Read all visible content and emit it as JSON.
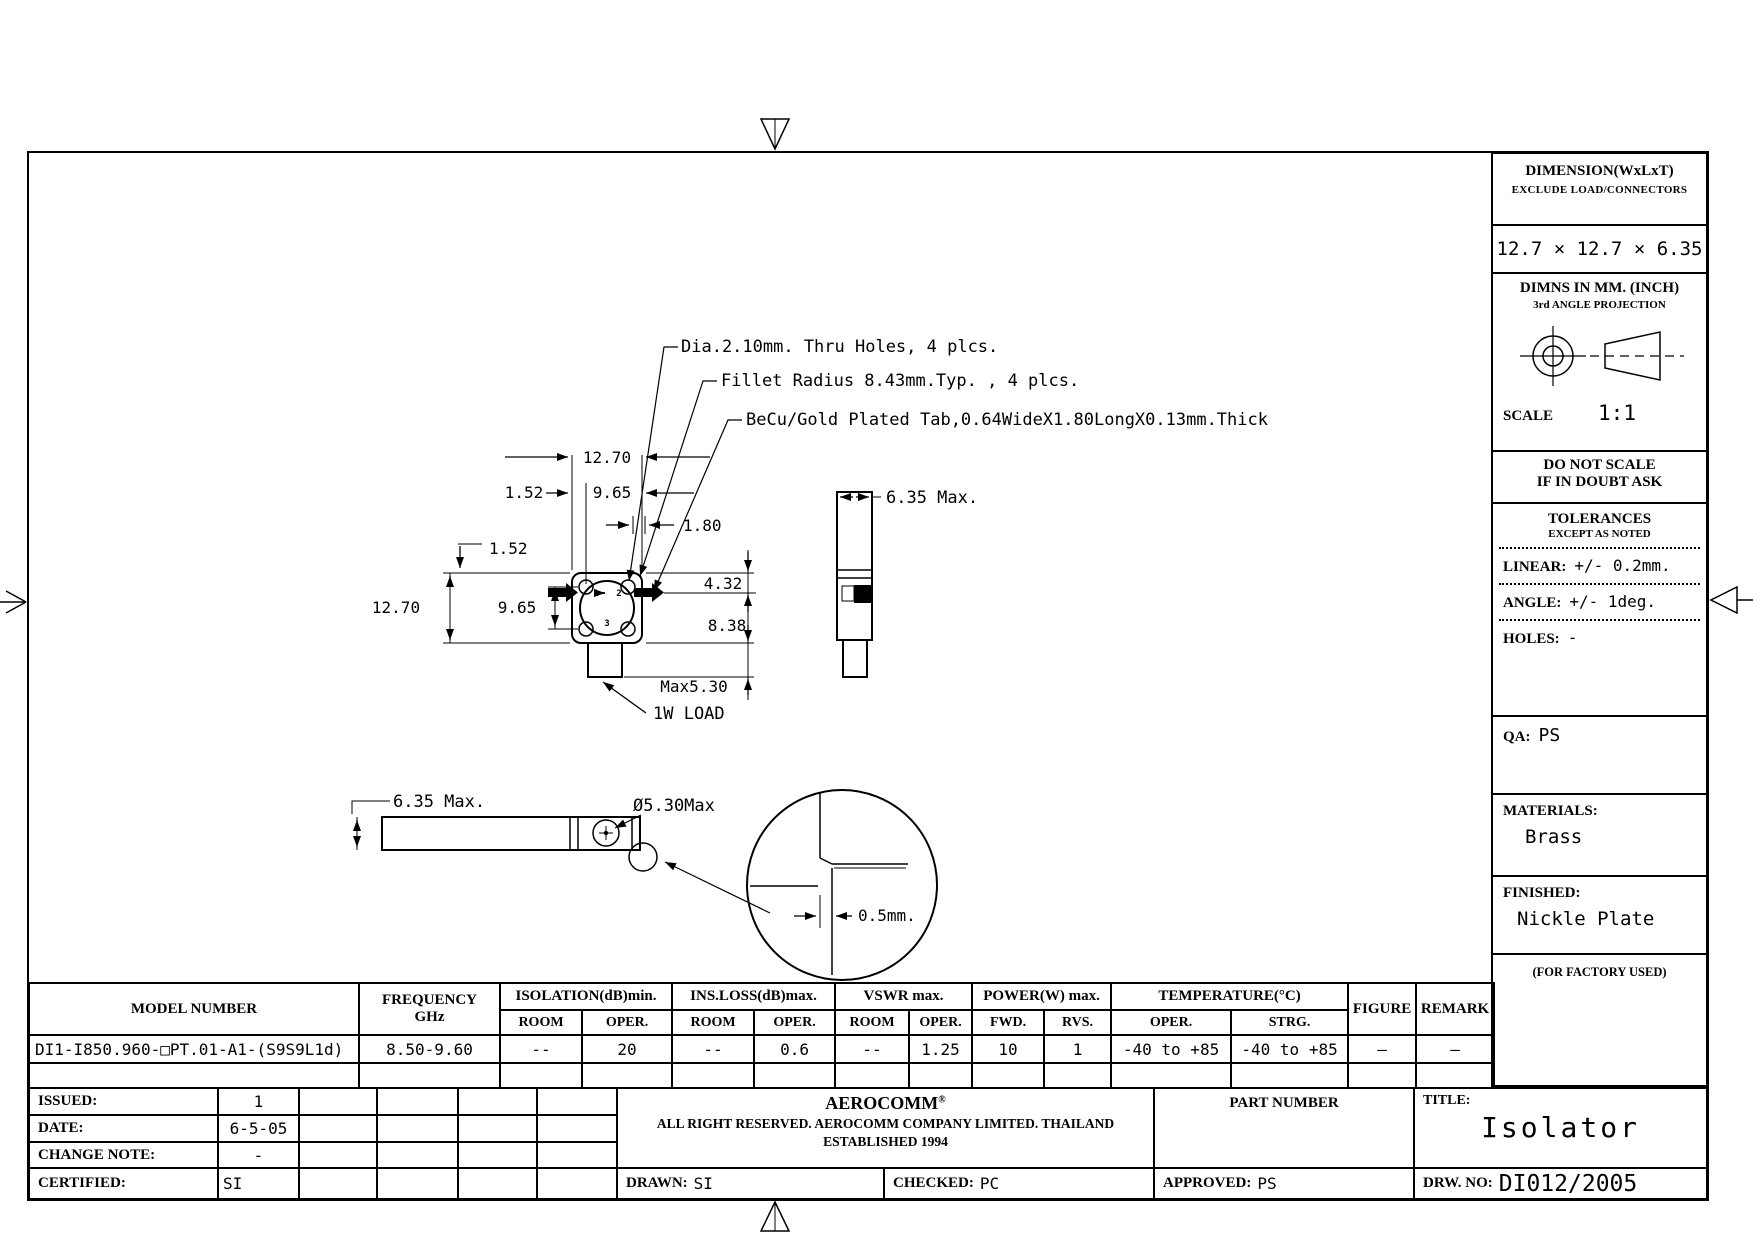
{
  "drawing": {
    "ann_holes": "Dia.2.10mm. Thru Holes, 4 plcs.",
    "ann_fillet": "Fillet Radius 8.43mm.Typ. , 4 plcs.",
    "ann_tab": "BeCu/Gold Plated Tab,0.64WideX1.80LongX0.13mm.Thick",
    "ann_load": "1W LOAD",
    "dim_top_width": "12.70",
    "dim_top_152": "1.52",
    "dim_top_965": "9.65",
    "dim_tab_len": "1.80",
    "dim_hole_off": "1.52",
    "dim_left_height": "12.70",
    "dim_left_holes": "9.65",
    "dim_432": "4.32",
    "dim_838": "8.38",
    "dim_load_len": "Max5.30",
    "port1": "1",
    "port2": "2",
    "port3": "3",
    "side_dim": "6.35 Max.",
    "bottom_dim": "6.35 Max.",
    "bottom_dia": "Ø5.30Max",
    "detail_step": "0.5mm."
  },
  "sidebar": {
    "dim_title": "DIMENSION(WxLxT)",
    "dim_sub": "EXCLUDE LOAD/CONNECTORS",
    "dim_value": "12.7 × 12.7 × 6.35",
    "units_line1": "DIMNS IN MM. (INCH)",
    "units_line2": "3rd ANGLE PROJECTION",
    "scale_label": "SCALE",
    "scale_value": "1:1",
    "warn1": "DO NOT SCALE",
    "warn2": "IF IN DOUBT ASK",
    "tol_title": "TOLERANCES",
    "tol_sub": "EXCEPT AS NOTED",
    "tol_linear_label": "LINEAR:",
    "tol_linear_value": "+/- 0.2mm.",
    "tol_angle_label": "ANGLE:",
    "tol_angle_value": "+/- 1deg.",
    "tol_holes_label": "HOLES:",
    "tol_holes_value": "-",
    "qa_label": "QA:",
    "qa_value": "PS",
    "materials_label": "MATERIALS:",
    "materials_value": "Brass",
    "finished_label": "FINISHED:",
    "finished_value": "Nickle Plate",
    "factory_note": "(FOR FACTORY USED)"
  },
  "spec_table": {
    "h_model": "MODEL NUMBER",
    "h_freq1": "FREQUENCY",
    "h_freq2": "GHz",
    "h_isolation": "ISOLATION(dB)min.",
    "h_insloss": "INS.LOSS(dB)max.",
    "h_vswr": "VSWR  max.",
    "h_power": "POWER(W)  max.",
    "h_temp": "TEMPERATURE(°C)",
    "h_figure": "FIGURE",
    "h_remark": "REMARK",
    "h_room": "ROOM",
    "h_oper": "OPER.",
    "h_fwd": "FWD.",
    "h_rvs": "RVS.",
    "h_strg": "STRG.",
    "row": {
      "model": "DI1-I850.960-□PT.01-A1-(S9S9L1d)",
      "freq": "8.50-9.60",
      "iso_room": "--",
      "iso_oper": "20",
      "ins_room": "--",
      "ins_oper": "0.6",
      "vswr_room": "--",
      "vswr_oper": "1.25",
      "pwr_fwd": "10",
      "pwr_rvs": "1",
      "temp_oper": "-40 to +85",
      "temp_strg": "-40 to +85",
      "figure": "—",
      "remark": "—"
    }
  },
  "title_block": {
    "issued_label": "ISSUED:",
    "issued_value": "1",
    "date_label": "DATE:",
    "date_value": "6-5-05",
    "change_label": "CHANGE NOTE:",
    "change_value": "-",
    "certified_label": "CERTIFIED:",
    "certified_value": "SI",
    "company_name": "AEROCOMM",
    "company_mark": "®",
    "company_line1": "ALL RIGHT RESERVED. AEROCOMM COMPANY LIMITED. THAILAND",
    "company_line2": "ESTABLISHED 1994",
    "part_label": "PART NUMBER",
    "title_label": "TITLE:",
    "title_value": "Isolator",
    "drawn_label": "DRAWN:",
    "drawn_value": "SI",
    "checked_label": "CHECKED:",
    "checked_value": "PC",
    "approved_label": "APPROVED:",
    "approved_value": "PS",
    "drwno_label": "DRW. NO:",
    "drwno_value": "DI012/2005"
  }
}
